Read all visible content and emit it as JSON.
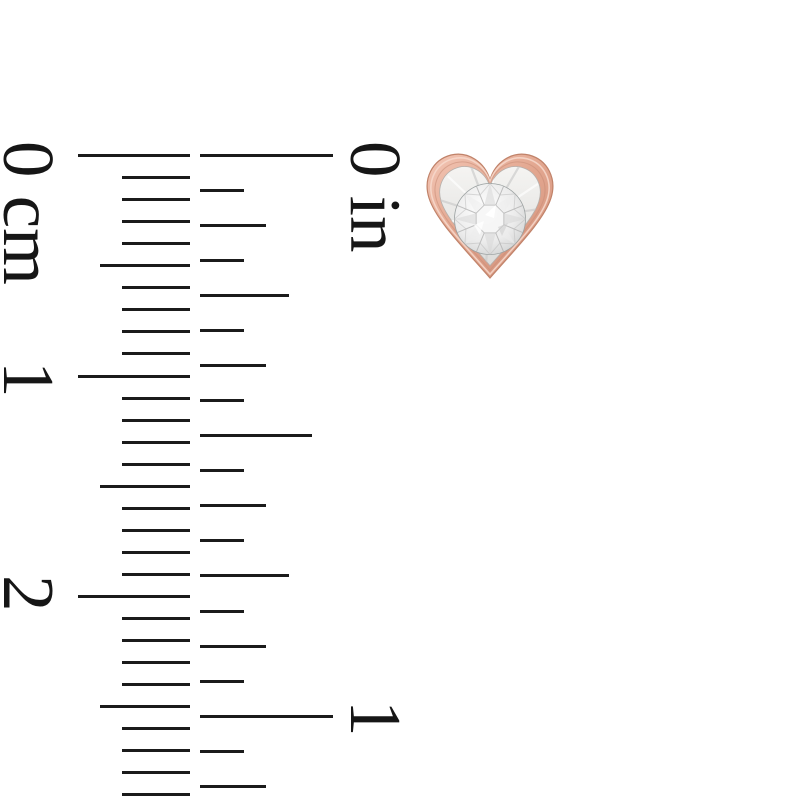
{
  "page": {
    "background_color": "#ffffff"
  },
  "ruler": {
    "tick_color": "#1b1b1b",
    "tick_thickness_px": 3,
    "zero_y_px": 155.5,
    "cm_scale": {
      "unit": "cm",
      "labels": [
        {
          "text": "0 cm",
          "top_px": 141
        },
        {
          "text": "1",
          "top_px": 361
        },
        {
          "text": "2",
          "top_px": 575
        }
      ],
      "label_column_left_px": 65,
      "ticks": {
        "count": 30,
        "spacing_px": 22.05,
        "right_edge_px": 190,
        "length_major_px": 112,
        "length_half_px": 90,
        "length_minor_px": 68
      }
    },
    "in_scale": {
      "unit": "in",
      "labels": [
        {
          "text": "0 in",
          "top_px": 141
        },
        {
          "text": "1",
          "top_px": 700
        }
      ],
      "label_column_left_px": 412,
      "ticks": {
        "count": 19,
        "spacing_px": 35.04,
        "left_edge_px": 200,
        "length_whole_px": 133,
        "length_half_px": 112,
        "length_quarter_px": 89,
        "length_eighth_px": 66,
        "length_sixteenth_px": 44
      }
    }
  },
  "earring": {
    "shape": "heart-bezel-stud",
    "stone": "round-brilliant-diamond-illusion-set",
    "colors": {
      "rose_gold_light": "#f3c6b5",
      "rose_gold": "#e2a68f",
      "rose_gold_dark": "#d3937c",
      "bezel_edge": "#c08269",
      "bezel_rim_highlight": "#f7d9cc",
      "bezel_groove": "#c98d77",
      "plate_light": "#f5f4f2",
      "plate_dark": "#dcdcda",
      "plate_edge": "#b5b0ac",
      "stone_white": "#ffffff",
      "stone_mid": "#ececec",
      "stone_gray": "#c7c9c9",
      "stone_ring": "#9aa0a0",
      "facet_line": "#aeaeae",
      "shard_gray": "#c9c9c9"
    }
  }
}
